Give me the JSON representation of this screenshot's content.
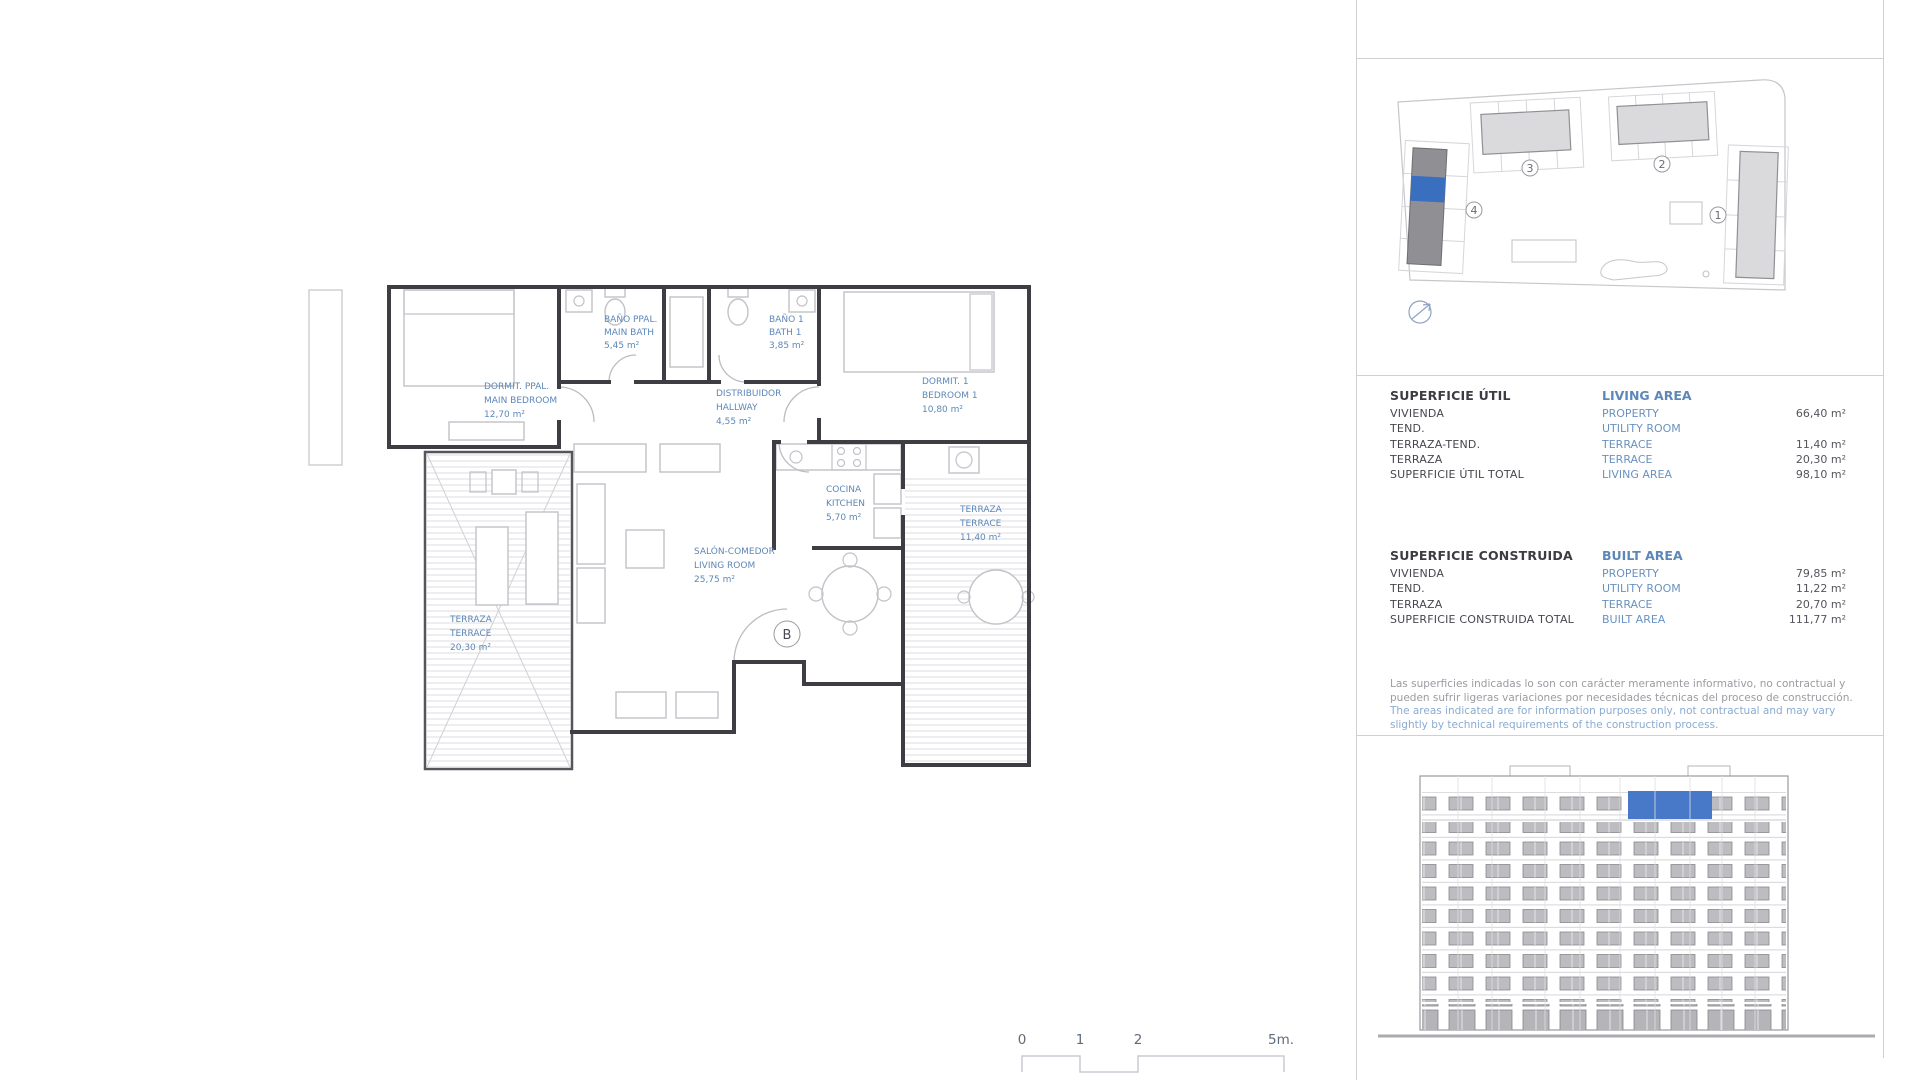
{
  "unit": {
    "letter": "B"
  },
  "plan": {
    "rooms": {
      "main_bedroom": {
        "l1": "DORMIT. PPAL.",
        "l2": "MAIN BEDROOM",
        "l3": "12,70 m²"
      },
      "main_bath": {
        "l1": "BAÑO PPAL.",
        "l2": "MAIN BATH",
        "l3": "5,45 m²"
      },
      "bath1": {
        "l1": "BAÑO 1",
        "l2": "BATH 1",
        "l3": "3,85 m²"
      },
      "bedroom1": {
        "l1": "DORMIT. 1",
        "l2": "BEDROOM 1",
        "l3": "10,80 m²"
      },
      "hallway": {
        "l1": "DISTRIBUIDOR",
        "l2": "HALLWAY",
        "l3": "4,55 m²"
      },
      "kitchen": {
        "l1": "COCINA",
        "l2": "KITCHEN",
        "l3": "5,70 m²"
      },
      "living": {
        "l1": "SALÓN-COMEDOR",
        "l2": "LIVING ROOM",
        "l3": "25,75 m²"
      },
      "terrace_right": {
        "l1": "TERRAZA",
        "l2": "TERRACE",
        "l3": "11,40 m²"
      },
      "terrace_left": {
        "l1": "TERRAZA",
        "l2": "TERRACE",
        "l3": "20,30 m²"
      }
    }
  },
  "site_plan": {
    "labels": {
      "b1": "1",
      "b2": "2",
      "b3": "3",
      "b4": "4"
    }
  },
  "scale_bar": {
    "t0": "0",
    "t1": "1",
    "t2": "2",
    "t5": "5m."
  },
  "tables": {
    "living": {
      "title_es": "SUPERFICIE ÚTIL",
      "title_en": "LIVING AREA",
      "rows": [
        {
          "es": "VIVIENDA",
          "en": "PROPERTY",
          "val": "66,40 m²"
        },
        {
          "es": "TEND.",
          "en": "UTILITY ROOM",
          "val": ""
        },
        {
          "es": "TERRAZA-TEND.",
          "en": "TERRACE",
          "val": "11,40 m²"
        },
        {
          "es": "TERRAZA",
          "en": "TERRACE",
          "val": "20,30 m²"
        },
        {
          "es": "SUPERFICIE ÚTIL TOTAL",
          "en": "LIVING AREA",
          "val": "98,10 m²"
        }
      ]
    },
    "built": {
      "title_es": "SUPERFICIE CONSTRUIDA",
      "title_en": "BUILT AREA",
      "rows": [
        {
          "es": "VIVIENDA",
          "en": "PROPERTY",
          "val": "79,85 m²"
        },
        {
          "es": "TEND.",
          "en": "UTILITY ROOM",
          "val": "11,22 m²"
        },
        {
          "es": "TERRAZA",
          "en": "TERRACE",
          "val": "20,70 m²"
        },
        {
          "es": "SUPERFICIE CONSTRUIDA TOTAL",
          "en": "BUILT AREA",
          "val": "111,77 m²"
        }
      ]
    }
  },
  "disclaimer": {
    "es": "Las superficies indicadas lo son con carácter meramente informativo, no contractual y pueden sufrir ligeras variaciones por necesidades técnicas del proceso de construcción.",
    "en": "The areas indicated are for information purposes only, not contractual and may vary slightly by technical requirements of the construction process."
  },
  "colors": {
    "highlight_blue": "#3a6fc0",
    "label_blue": "#5d87b8",
    "selected_building_gray": "#909094"
  }
}
